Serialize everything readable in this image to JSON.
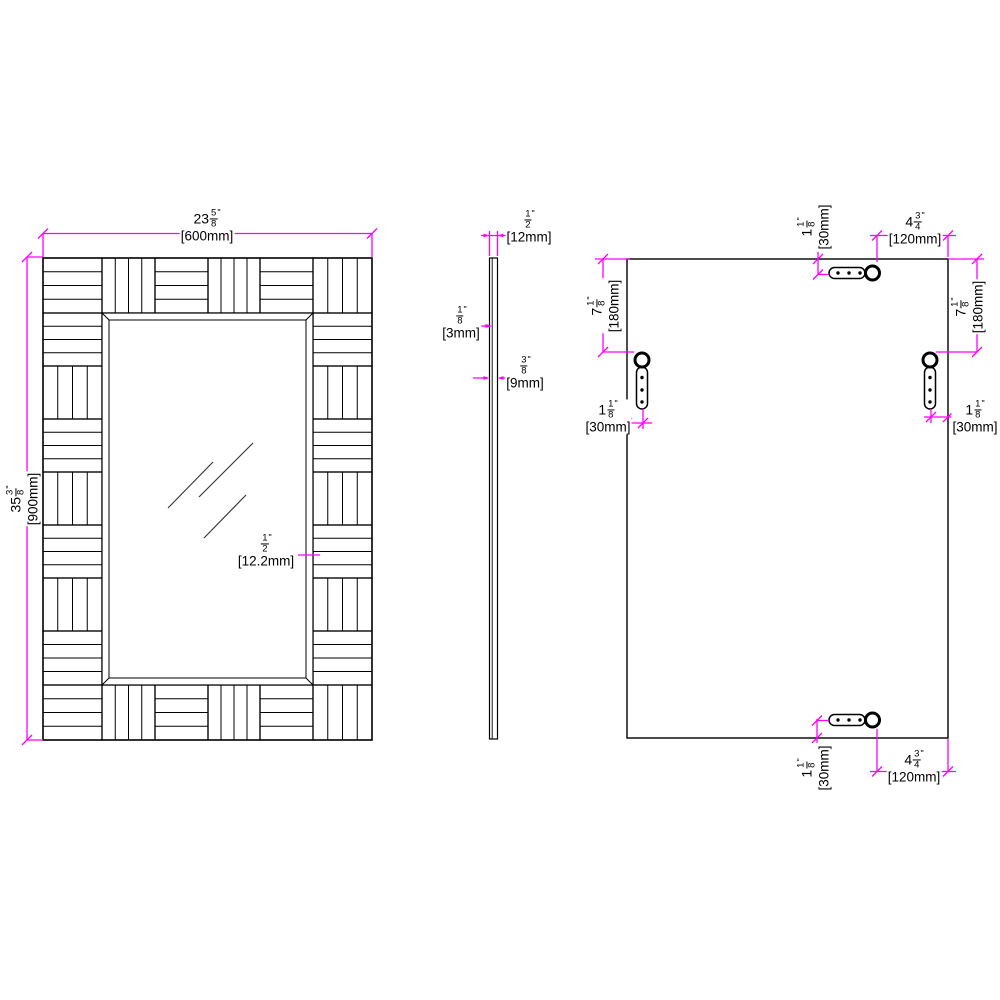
{
  "colors": {
    "dimension": "#ff00ff",
    "line": "#000000",
    "background": "#ffffff"
  },
  "dims": {
    "front_width": {
      "w": "23",
      "n": "5",
      "d": "8",
      "q": "\"",
      "m": "[600mm]"
    },
    "front_height": {
      "w": "35",
      "n": "3",
      "d": "8",
      "q": "\"",
      "m": "[900mm]"
    },
    "front_thickness": {
      "w": "",
      "n": "1",
      "d": "2",
      "q": "\"",
      "m": "[12.2mm]"
    },
    "side_depth": {
      "w": "",
      "n": "1",
      "d": "2",
      "q": "\"",
      "m": "[12mm]"
    },
    "side_glass": {
      "w": "",
      "n": "1",
      "d": "8",
      "q": "\"",
      "m": "[3mm]"
    },
    "side_panel": {
      "w": "",
      "n": "3",
      "d": "8",
      "q": "\"",
      "m": "[9mm]"
    },
    "back_top_offset": {
      "w": "1",
      "n": "1",
      "d": "8",
      "q": "\"",
      "m": "[30mm]"
    },
    "back_top_inset": {
      "w": "4",
      "n": "3",
      "d": "4",
      "q": "\"",
      "m": "[120mm]"
    },
    "back_left_drop": {
      "w": "7",
      "n": "1",
      "d": "8",
      "q": "\"",
      "m": "[180mm]"
    },
    "back_left_inset": {
      "w": "1",
      "n": "1",
      "d": "8",
      "q": "\"",
      "m": "[30mm]"
    },
    "back_right_drop": {
      "w": "7",
      "n": "1",
      "d": "8",
      "q": "\"",
      "m": "[180mm]"
    },
    "back_right_inset": {
      "w": "1",
      "n": "1",
      "d": "8",
      "q": "\"",
      "m": "[30mm]"
    },
    "back_bottom_offset": {
      "w": "1",
      "n": "1",
      "d": "8",
      "q": "\"",
      "m": "[30mm]"
    },
    "back_bottom_inset": {
      "w": "4",
      "n": "3",
      "d": "4",
      "q": "\"",
      "m": "[120mm]"
    }
  }
}
